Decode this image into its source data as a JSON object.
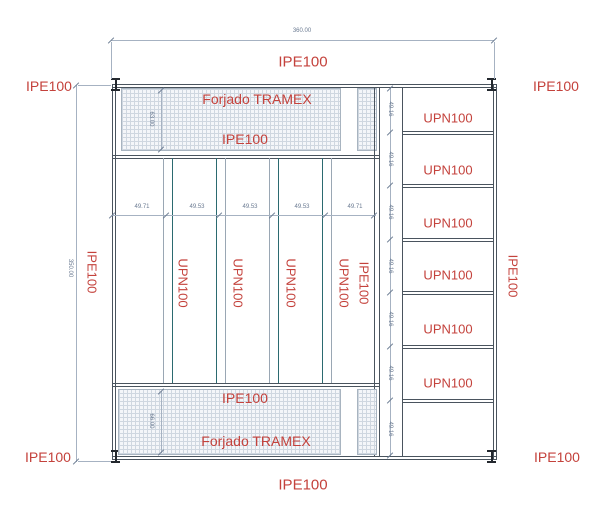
{
  "drawing": {
    "corner_labels": {
      "top_left": "IPE100",
      "top_right": "IPE100",
      "bottom_left": "IPE100",
      "bottom_right": "IPE100"
    },
    "edge_labels": {
      "top": "IPE100",
      "bottom": "IPE100",
      "left": "IPE100",
      "right": "IPE100"
    },
    "overall_dims": {
      "width": "360.00",
      "height": "350.00"
    },
    "top_band": {
      "name": "Forjado TRAMEX",
      "beam": "IPE100",
      "depth": "63.00"
    },
    "bottom_band": {
      "beam": "IPE100",
      "name": "Forjado TRAMEX",
      "depth": "66.00"
    },
    "central": {
      "bay_dims": [
        "49.71",
        "49.53",
        "49.53",
        "49.53",
        "49.71"
      ],
      "member_labels": [
        "UPN100",
        "UPN100",
        "UPN100",
        "UPN100"
      ],
      "right_member_label": "IPE100"
    },
    "right_zone": {
      "bays": [
        {
          "label": "UPN100",
          "dim": "49.16"
        },
        {
          "label": "UPN100",
          "dim": "49.16"
        },
        {
          "label": "UPN100",
          "dim": "49.16"
        },
        {
          "label": "UPN100",
          "dim": "49.16"
        },
        {
          "label": "UPN100",
          "dim": "49.16"
        },
        {
          "label": "UPN100",
          "dim": "49.16"
        },
        {
          "label": "",
          "dim": "49.16"
        }
      ]
    },
    "colors": {
      "label_red": "#c4423c",
      "line_dark": "#4a545e",
      "line_teal": "#2b6a70",
      "line_light": "#9aa7b4",
      "dim_gray": "#6b7b92"
    }
  }
}
